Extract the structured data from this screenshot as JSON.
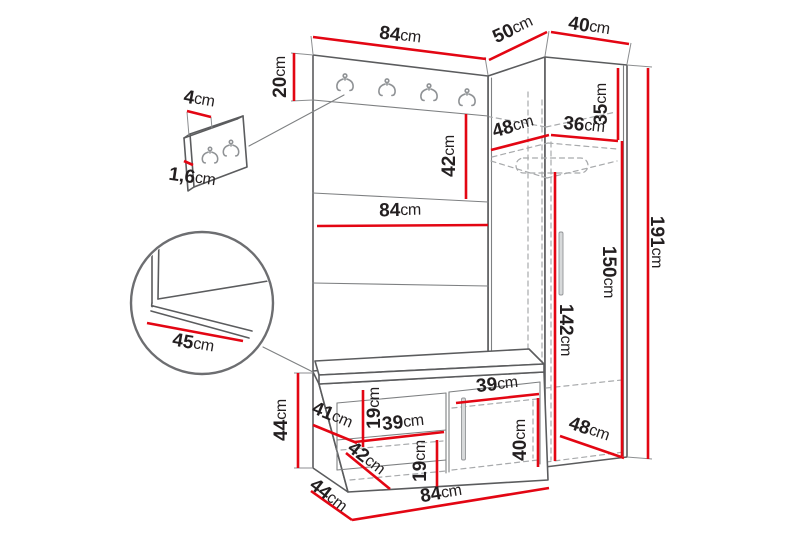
{
  "title": "Hallway furniture set dimensions diagram",
  "unit": "cm",
  "colors": {
    "dimension_line": "#e30613",
    "outline": "#5b5c5e",
    "hidden_line": "#a8aaac",
    "label_text": "#231f20",
    "background": "#ffffff"
  },
  "dimensions": {
    "main_panel_width_top": {
      "value": "84"
    },
    "corner_front_width": {
      "value": "50"
    },
    "corner_side_width": {
      "value": "40"
    },
    "hook_rail_height": {
      "value": "20"
    },
    "hook_panel_depth": {
      "value": "4"
    },
    "hook_panel_thickness": {
      "value": "1,6"
    },
    "upholstered_panel_height": {
      "value": "42"
    },
    "main_panel_width_middle": {
      "value": "84"
    },
    "corner_shelf_depth": {
      "value": "48"
    },
    "corner_shelf_width": {
      "value": "36"
    },
    "corner_top_section_height": {
      "value": "35"
    },
    "hanging_space_height": {
      "value": "142"
    },
    "wardrobe_front_height": {
      "value": "150"
    },
    "total_height": {
      "value": "191"
    },
    "seat_depth_detail": {
      "value": "45"
    },
    "bench_height": {
      "value": "44"
    },
    "bench_side_depth": {
      "value": "41"
    },
    "bench_upper_shelf_height": {
      "value": "19"
    },
    "bench_left_shelf_width": {
      "value": "39"
    },
    "bench_right_shelf_width": {
      "value": "39"
    },
    "bench_base_depth_inner": {
      "value": "42"
    },
    "bench_lower_shelf_height": {
      "value": "19"
    },
    "bench_right_compartment_height": {
      "value": "40"
    },
    "bench_floor_depth": {
      "value": "44"
    },
    "bench_width": {
      "value": "84"
    },
    "wardrobe_bottom_depth": {
      "value": "48"
    }
  }
}
